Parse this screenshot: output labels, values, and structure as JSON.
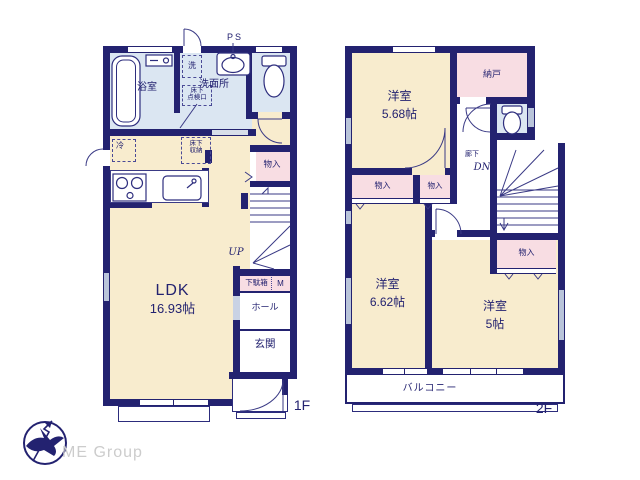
{
  "colors": {
    "wall_navy": "#232270",
    "room_cream": "#f8ecce",
    "wet_blue": "#dbe6f2",
    "closet_pink": "#f8dde3",
    "window_gray": "#b9c4da",
    "logo_gray": "#cccccc"
  },
  "logo": {
    "company": "ME Group",
    "north_mark": "compass-arrow-icon"
  },
  "floor1": {
    "floor_label": "1F",
    "ps_label": "PS",
    "up_label": "UP",
    "rooms": {
      "bathroom": "浴室",
      "washer": "洗",
      "washroom": "洗面所",
      "underfloor_access": "床下\n点検口",
      "fridge": "冷",
      "underfloor_storage": "床下\n収納",
      "closet": "物入",
      "shoe_cabinet": "下駄箱",
      "meter": "M",
      "hall": "ホール",
      "entrance": "玄関",
      "ldk_name": "LDK",
      "ldk_size": "16.93帖"
    }
  },
  "floor2": {
    "floor_label": "2F",
    "dn_label": "DN",
    "rooms": {
      "bedroom1_name": "洋室",
      "bedroom1_size": "5.68帖",
      "storage": "納戸",
      "corridor": "廊下",
      "closet_a": "物入",
      "closet_b": "物入",
      "closet_c": "物入",
      "bedroom2_name": "洋室",
      "bedroom2_size": "6.62帖",
      "bedroom3_name": "洋室",
      "bedroom3_size": "5帖",
      "balcony": "バルコニー"
    }
  }
}
